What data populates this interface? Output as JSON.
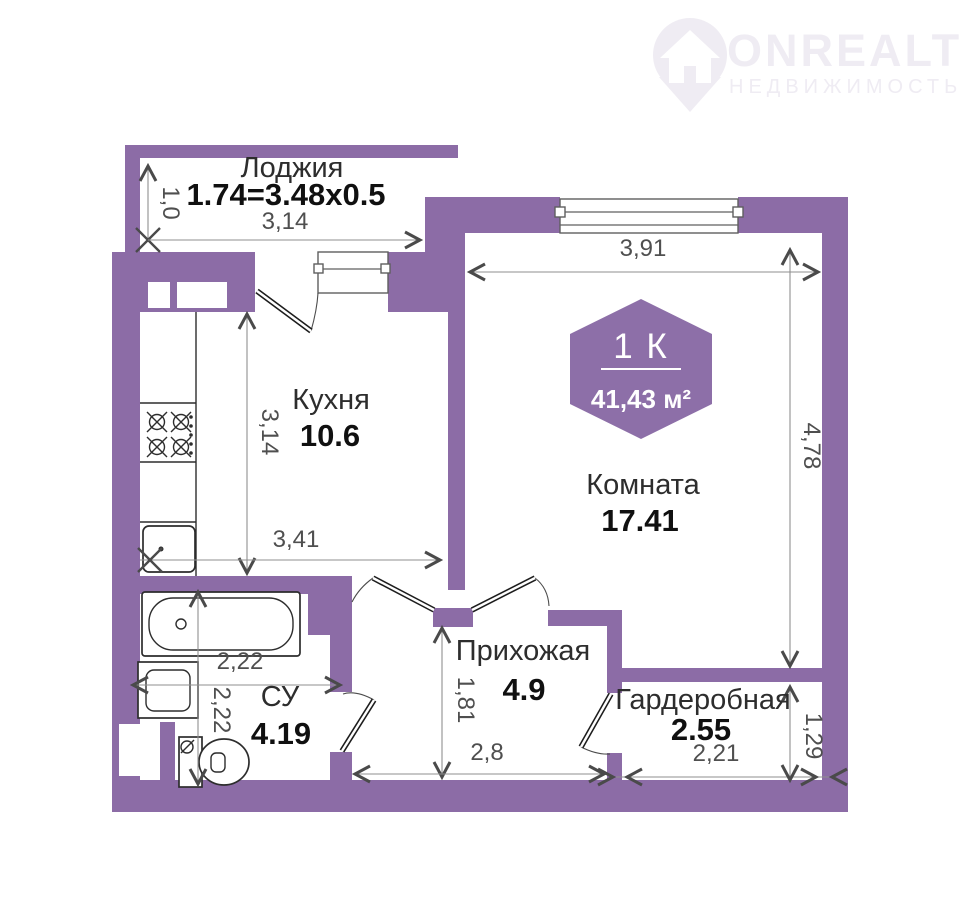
{
  "watermark": {
    "brand": "ONREALT",
    "tagline": "НЕДВИЖИМОСТЬ"
  },
  "badge": {
    "rooms_label": "1 К",
    "total_area": "41,43 м²"
  },
  "rooms": {
    "loggia": {
      "name": "Лоджия",
      "area_formula": "1.74=3.48x0.5",
      "dim_width": "3,14",
      "dim_depth": "1,0"
    },
    "kitchen": {
      "name": "Кухня",
      "area": "10.6",
      "dim_depth": "3,14",
      "dim_width": "3,41"
    },
    "living_room": {
      "name": "Комната",
      "area": "17.41",
      "dim_width": "3,91",
      "dim_height": "4,78"
    },
    "hallway": {
      "name": "Прихожая",
      "area": "4.9",
      "dim_depth": "1,81",
      "dim_width": "2,8"
    },
    "bathroom": {
      "name": "СУ",
      "area": "4.19",
      "dim_width": "2,22",
      "dim_depth": "2,22"
    },
    "wardrobe": {
      "name": "Гардеробная",
      "area": "2.55",
      "dim_width": "2,21",
      "dim_depth": "1,29"
    }
  },
  "colors": {
    "wall": "#8c6ca6",
    "badge": "#8d6fa8",
    "dimension_text": "#4f4f4f",
    "label_text": "#2d2d2d",
    "watermark": "#efecf3"
  }
}
